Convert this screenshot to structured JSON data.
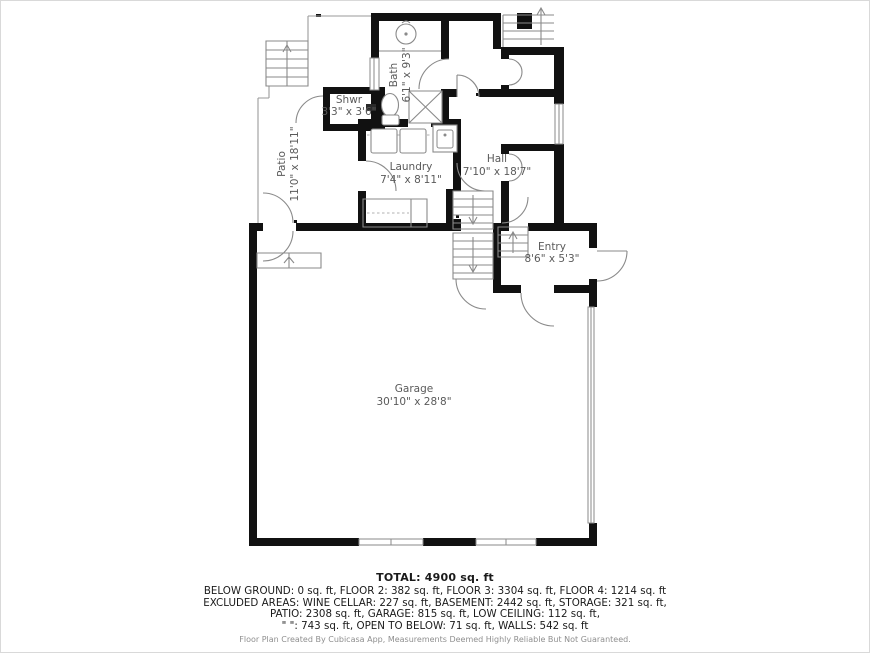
{
  "plan": {
    "rooms": [
      {
        "name": "Bath",
        "dims": "6'1\" x 9'3\""
      },
      {
        "name": "Shwr",
        "dims": "3'3\" x 3'6\""
      },
      {
        "name": "Patio",
        "dims": "11'0\" x 18'11\""
      },
      {
        "name": "Laundry",
        "dims": "7'4\" x 8'11\""
      },
      {
        "name": "Hall",
        "dims": "7'10\" x 18'7\""
      },
      {
        "name": "Entry",
        "dims": "8'6\" x 5'3\""
      },
      {
        "name": "Garage",
        "dims": "30'10\" x 28'8\""
      }
    ]
  },
  "summary": {
    "total": "TOTAL: 4900 sq. ft",
    "lines": [
      "BELOW GROUND: 0 sq. ft, FLOOR 2: 382 sq. ft, FLOOR 3: 3304 sq. ft, FLOOR 4: 1214 sq. ft",
      "EXCLUDED AREAS: WINE CELLAR: 227 sq. ft, BASEMENT: 2442 sq. ft, STORAGE: 321 sq. ft,",
      "PATIO: 2308 sq. ft, GARAGE: 815 sq. ft, LOW CEILING: 112 sq. ft,",
      "\" \": 743 sq. ft, OPEN TO BELOW: 71 sq. ft, WALLS: 542 sq. ft"
    ]
  },
  "footer": {
    "credit": "Floor Plan Created By Cubicasa App, Measurements Deemed Highly Reliable But Not Guaranteed."
  },
  "colors": {
    "wall": "#111111",
    "thin_line": "#8a8a8a",
    "label_text": "#5a5a5a",
    "summary_text": "#1a1a1a",
    "footer_text": "#8f8f8f",
    "background": "#ffffff"
  }
}
